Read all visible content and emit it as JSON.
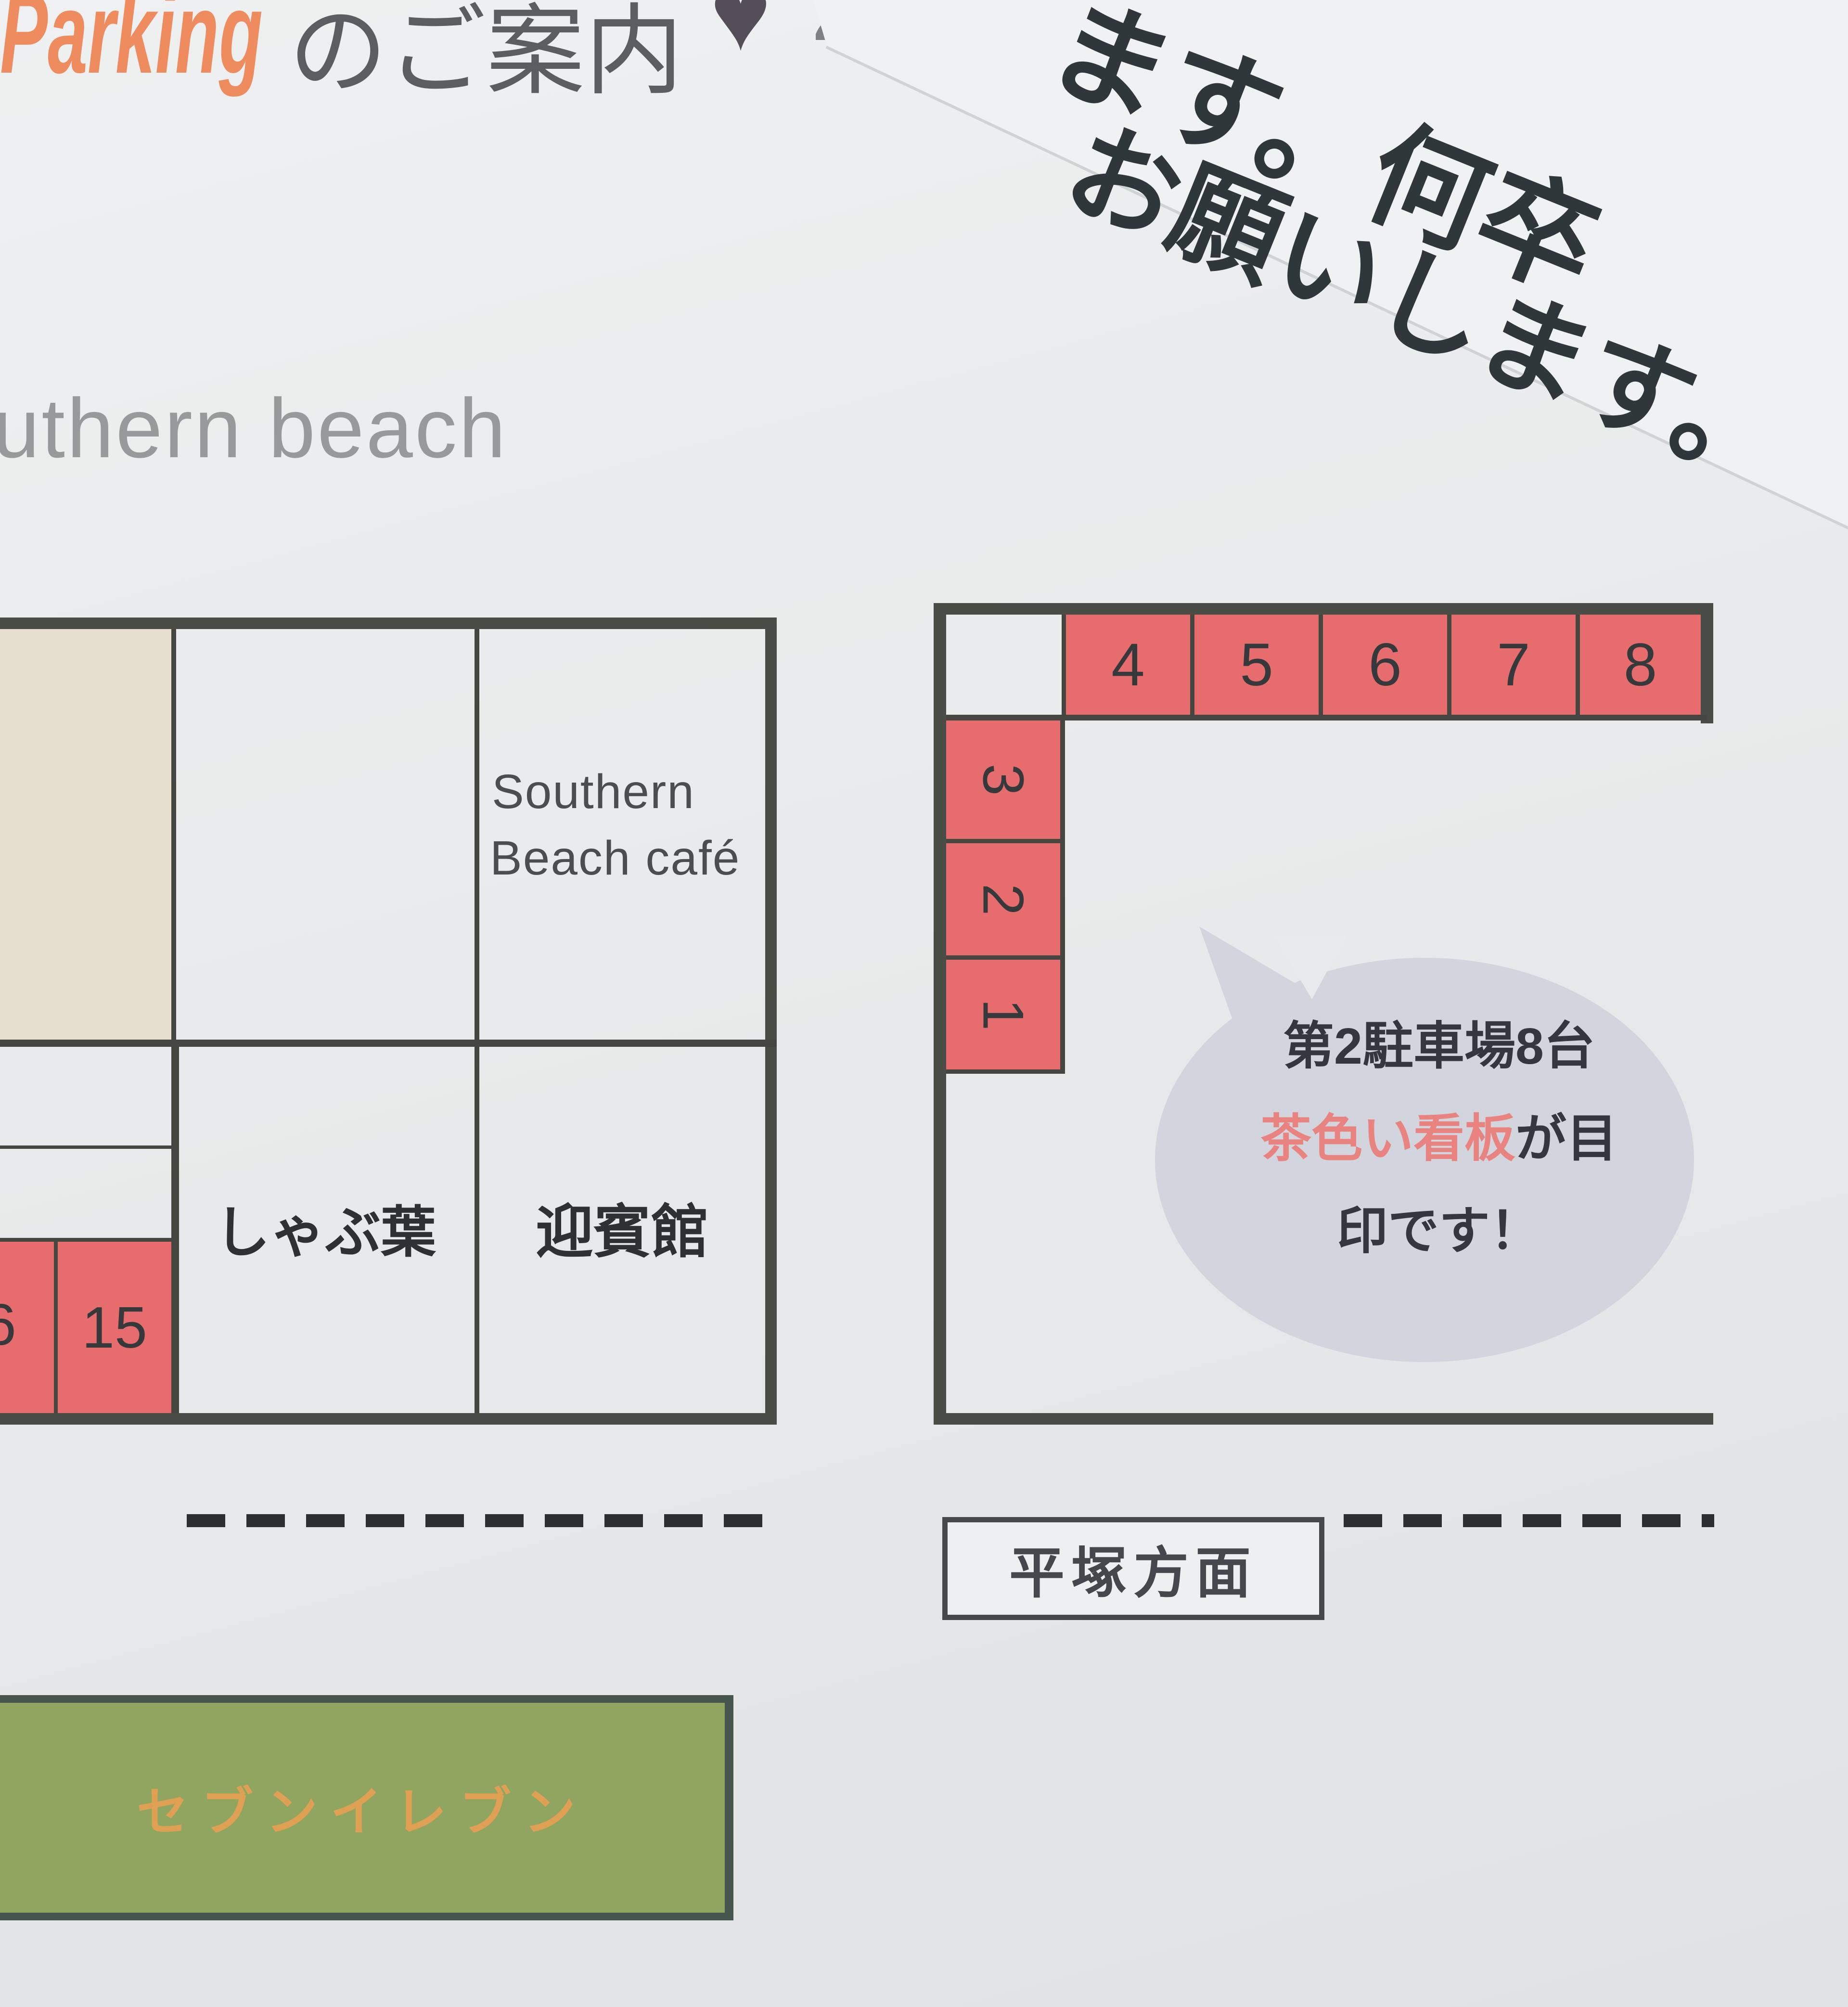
{
  "header": {
    "title_en": "Parking",
    "title_ja": "のご案内",
    "heart": "♥",
    "partial_char": "2"
  },
  "handwritten_note": {
    "line1": "ます。何卒",
    "line2": "お願いします。"
  },
  "beach_label": "uthern beach",
  "left_lot": {
    "cafe_name_line1": "Southern",
    "cafe_name_line2": "Beach café",
    "restaurant_shabu": "しゃぶ葉",
    "restaurant_geihinkan": "迎賓館",
    "spot_partial": "6",
    "spot_15": "15"
  },
  "right_lot": {
    "top_spots": [
      "4",
      "5",
      "6",
      "7",
      "8"
    ],
    "side_spots": [
      "3",
      "2",
      "1"
    ],
    "bubble": {
      "line1": "第2駐車場8台",
      "line2_red": "茶色い看板",
      "line2_black": "が目",
      "line3": "印です！"
    }
  },
  "road": {
    "direction_sign": "平塚方面"
  },
  "store": {
    "name": "セブンイレブン"
  },
  "colors": {
    "spot_red": "#e76c6e",
    "beige": "#e6decf",
    "building_green": "#8fa560",
    "title_orange": "#ee8c60",
    "store_text_orange": "#dfa054",
    "bubble_gray": "#d2d4de",
    "bubble_highlight_red": "#e8837f",
    "line_dark": "#4a4c46"
  }
}
